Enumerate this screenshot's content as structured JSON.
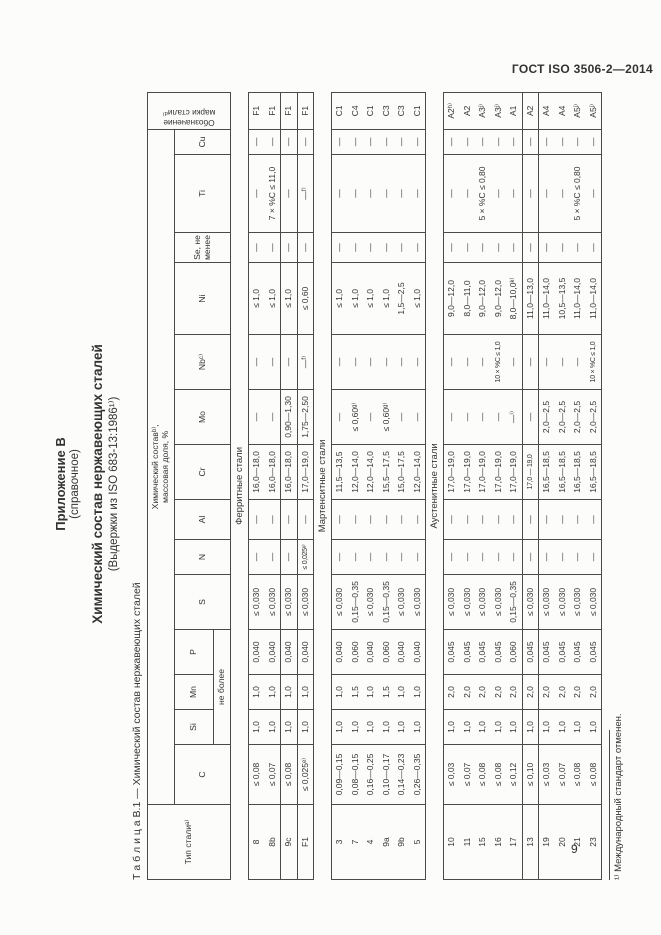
{
  "page": {
    "standard_ref": "ГОСТ ISO 3506-2—2014",
    "page_number": "9"
  },
  "appendix": {
    "label": "Приложение В",
    "kind": "(справочное)",
    "title": "Химический состав нержавеющих сталей",
    "subtitle": "(Выдержки из ISO 683-13:1986¹⁾)"
  },
  "table": {
    "caption": "Т а б л и ц а  В.1 — Химический состав нержавеющих сталей",
    "headers": {
      "type": "Тип сталиᵃ⁾",
      "composition_line1": "Химический составᵇ⁾,",
      "composition_line2": "массовая доля, %",
      "not_more": "не более",
      "grade_line1": "Обозначение",
      "grade_line2": "марки сталиᵈ⁾",
      "elements": [
        "C",
        "Si",
        "Mn",
        "P",
        "S",
        "N",
        "Al",
        "Cr",
        "Mo",
        "Nbᶜ⁾",
        "Ni",
        "Se, не менее",
        "Ti",
        "Cu"
      ]
    },
    "sections": [
      {
        "label": "Ферритные стали",
        "groups": [
          {
            "rows": [
              [
                "8",
                "≤ 0,08",
                "1,0",
                "1,0",
                "0,040",
                "≤ 0,030",
                "—",
                "—",
                "16,0—18,0",
                "—",
                "—",
                "≤ 1,0",
                "—",
                "—",
                "—",
                "F1"
              ],
              [
                "8b",
                "≤ 0,07",
                "1,0",
                "1,0",
                "0,040",
                "≤ 0,030",
                "—",
                "—",
                "16,0—18,0",
                "—",
                "—",
                "≤ 1,0",
                "—",
                "7 × %C ≤ 11,0",
                "—",
                "F1"
              ]
            ]
          },
          {
            "rows": [
              [
                "9c",
                "≤ 0,08",
                "1,0",
                "1,0",
                "0,040",
                "≤ 0,030",
                "—",
                "—",
                "16,0—18,0",
                "0,90—1,30",
                "—",
                "≤ 1,0",
                "—",
                "—",
                "—",
                "F1"
              ]
            ]
          },
          {
            "rows": [
              [
                "F1",
                "≤ 0,025ᵉ⁾",
                "1,0",
                "1,0",
                "0,040",
                "≤ 0,030",
                "≤ 0,025ᵉ⁾",
                "—",
                "17,0—19,0",
                "1,75—2,50",
                "—ᶠ⁾",
                "≤ 0,60",
                "—",
                "—ᶠ⁾",
                "—",
                "F1"
              ]
            ]
          }
        ]
      },
      {
        "label": "Мартенситные стали",
        "groups": [
          {
            "rows": [
              [
                "3",
                "0,09—0,15",
                "1,0",
                "1,0",
                "0,040",
                "≤ 0,030",
                "—",
                "—",
                "11,5—13,5",
                "—",
                "—",
                "≤ 1,0",
                "—",
                "—",
                "—",
                "C1"
              ],
              [
                "7",
                "0,08—0,15",
                "1,0",
                "1,5",
                "0,060",
                "0,15—0,35",
                "—",
                "—",
                "12,0—14,0",
                "≤ 0,60ᵍ⁾",
                "—",
                "≤ 1,0",
                "—",
                "—",
                "—",
                "C4"
              ],
              [
                "4",
                "0,16—0,25",
                "1,0",
                "1,0",
                "0,040",
                "≤ 0,030",
                "—",
                "—",
                "12,0—14,0",
                "—",
                "—",
                "≤ 1,0",
                "—",
                "—",
                "—",
                "C1"
              ],
              [
                "9a",
                "0,10—0,17",
                "1,0",
                "1,5",
                "0,060",
                "0,15—0,35",
                "—",
                "—",
                "15,5—17,5",
                "≤ 0,60ᵍ⁾",
                "—",
                "≤ 1,0",
                "—",
                "—",
                "—",
                "C3"
              ],
              [
                "9b",
                "0,14—0,23",
                "1,0",
                "1,0",
                "0,040",
                "≤ 0,030",
                "—",
                "—",
                "15,0—17,5",
                "—",
                "—",
                "1,5—2,5",
                "—",
                "—",
                "—",
                "C3"
              ],
              [
                "5",
                "0,26—0,35",
                "1,0",
                "1,0",
                "0,040",
                "≤ 0,030",
                "—",
                "—",
                "12,0—14,0",
                "—",
                "—",
                "≤ 1,0",
                "—",
                "—",
                "—",
                "C1"
              ]
            ]
          }
        ]
      },
      {
        "label": "Аустенитные стали",
        "groups": [
          {
            "rows": [
              [
                "10",
                "≤ 0,03",
                "1,0",
                "2,0",
                "0,045",
                "≤ 0,030",
                "—",
                "—",
                "17,0—19,0",
                "—",
                "—",
                "9,0—12,0",
                "—",
                "—",
                "—",
                "A2ʰ⁾"
              ],
              [
                "11",
                "≤ 0,07",
                "1,0",
                "2,0",
                "0,045",
                "≤ 0,030",
                "—",
                "—",
                "17,0—19,0",
                "—",
                "—",
                "8,0—11,0",
                "—",
                "—",
                "—",
                "A2"
              ],
              [
                "15",
                "≤ 0,08",
                "1,0",
                "2,0",
                "0,045",
                "≤ 0,030",
                "—",
                "—",
                "17,0—19,0",
                "—",
                "—",
                "9,0—12,0",
                "—",
                "5 × %C ≤ 0,80",
                "—",
                "A3ʲ⁾"
              ],
              [
                "16",
                "≤ 0,08",
                "1,0",
                "2,0",
                "0,045",
                "≤ 0,030",
                "—",
                "—",
                "17,0—19,0",
                "—",
                "10 × %C ≤ 1,0",
                "9,0—12,0",
                "—",
                "—",
                "—",
                "A3ʲ⁾"
              ],
              [
                "17",
                "≤ 0,12",
                "1,0",
                "2,0",
                "0,060",
                "0,15—0,35",
                "—",
                "—",
                "17,0—19,0",
                "—ⁱ⁾",
                "—",
                "8,0—10,0ᵏ⁾",
                "—",
                "—",
                "—",
                "A1"
              ]
            ]
          },
          {
            "rows": [
              [
                "13",
                "≤ 0,10",
                "1,0",
                "2,0",
                "0,045",
                "≤ 0,030",
                "—",
                "—",
                "17,0 — 19,0",
                "—",
                "—",
                "11,0—13,0",
                "—",
                "—",
                "—",
                "A2"
              ]
            ]
          },
          {
            "rows": [
              [
                "19",
                "≤ 0,03",
                "1,0",
                "2,0",
                "0,045",
                "≤ 0,030",
                "—",
                "—",
                "16,5—18,5",
                "2,0—2,5",
                "—",
                "11,0—14,0",
                "—",
                "—",
                "—",
                "A4"
              ],
              [
                "20",
                "≤ 0,07",
                "1,0",
                "2,0",
                "0,045",
                "≤ 0,030",
                "—",
                "—",
                "16,5—18,5",
                "2,0—2,5",
                "—",
                "10,5—13,5",
                "—",
                "—",
                "—",
                "A4"
              ],
              [
                "21",
                "≤ 0,08",
                "1,0",
                "2,0",
                "0,045",
                "≤ 0,030",
                "—",
                "—",
                "16,5—18,5",
                "2,0—2,5",
                "—",
                "11,0—14,0",
                "—",
                "5 × %C ≤ 0,80",
                "—",
                "A5ʲ⁾"
              ],
              [
                "23",
                "≤ 0,08",
                "1,0",
                "2,0",
                "0,045",
                "≤ 0,030",
                "—",
                "—",
                "16,5—18,5",
                "2,0—2,5",
                "10 × %C ≤ 1,0",
                "11,0—14,0",
                "—",
                "—",
                "—",
                "A5ʲ⁾"
              ]
            ]
          }
        ]
      }
    ]
  },
  "footnote": "¹⁾ Международный стандарт отменен."
}
